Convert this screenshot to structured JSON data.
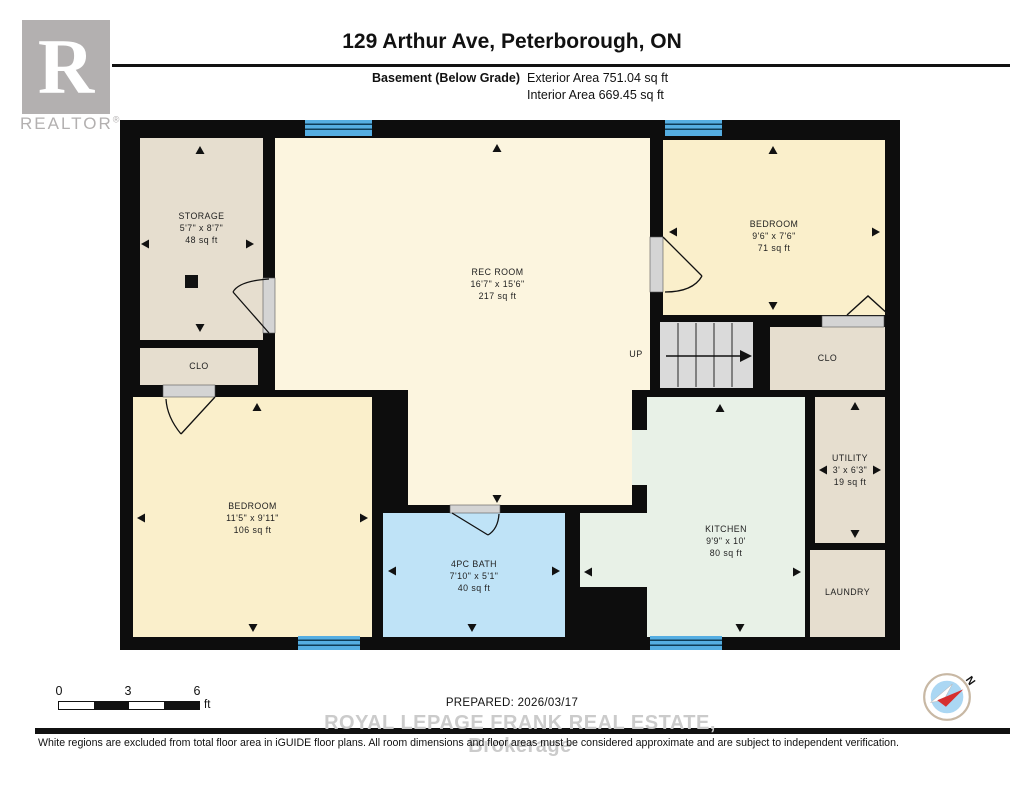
{
  "header": {
    "title": "129 Arthur Ave, Peterborough, ON",
    "floor_label": "Basement (Below Grade)",
    "exterior_area": "Exterior Area 751.04 sq ft",
    "interior_area": "Interior Area 669.45 sq ft"
  },
  "logo": {
    "letter": "R",
    "brand": "REALTOR",
    "registered": "®"
  },
  "plan": {
    "up_label": "UP",
    "rooms": {
      "storage": {
        "name": "STORAGE",
        "dims": "5'7\" x 8'7\"",
        "area": "48 sq ft"
      },
      "clo_left": {
        "name": "CLO"
      },
      "rec": {
        "name": "REC ROOM",
        "dims": "16'7\" x 15'6\"",
        "area": "217 sq ft"
      },
      "bedroom_tr": {
        "name": "BEDROOM",
        "dims": "9'6\" x 7'6\"",
        "area": "71 sq ft"
      },
      "clo_right": {
        "name": "CLO"
      },
      "utility": {
        "name": "UTILITY",
        "dims": "3' x 6'3\"",
        "area": "19 sq ft"
      },
      "laundry": {
        "name": "LAUNDRY"
      },
      "kitchen": {
        "name": "KITCHEN",
        "dims": "9'9\" x 10'",
        "area": "80 sq ft"
      },
      "bath": {
        "name": "4PC BATH",
        "dims": "7'10\" x 5'1\"",
        "area": "40 sq ft"
      },
      "bedroom_bl": {
        "name": "BEDROOM",
        "dims": "11'5\" x 9'11\"",
        "area": "106 sq ft"
      }
    }
  },
  "footer": {
    "scale": {
      "t0": "0",
      "t1": "3",
      "t2": "6",
      "unit": "ft"
    },
    "prepared": "PREPARED: 2026/03/17",
    "watermark": "ROYAL LEPAGE FRANK REAL ESTATE, Brokerage",
    "disclaimer": "White regions are excluded from total floor area in iGUIDE floor plans. All room dimensions and floor areas must be considered approximate and are subject to independent verification.",
    "compass_n": "N"
  },
  "colors": {
    "wall": "#0d0d0d",
    "cream": "#fcf5df",
    "bedroom_yellow": "#faefcb",
    "tan": "#e6decf",
    "kitchen_mint": "#e8f1e7",
    "bath_blue": "#bfe3f7",
    "window_blue": "#55aee2",
    "stairs_gray": "#dadada",
    "compass_red": "#d62f2f"
  }
}
